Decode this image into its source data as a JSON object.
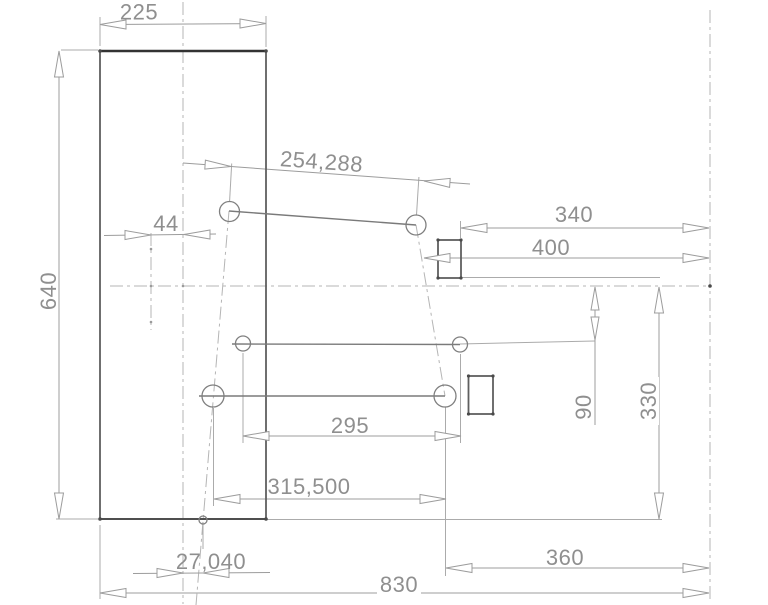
{
  "drawing": {
    "kind": "technical-dimension-drawing",
    "colors": {
      "background": "#ffffff",
      "part_edge": "#4f4f4f",
      "geometry_line": "#7a7a7a",
      "dimension_line": "#9c9c9c",
      "centerline": "#b5b5b5",
      "text": "#8f8f8f"
    },
    "dims": {
      "width_top": {
        "label": "225",
        "value": 225
      },
      "height_left": {
        "label": "640",
        "value": 640
      },
      "hole_distance": {
        "label": "254,288",
        "value": 254.288
      },
      "offset_center": {
        "label": "44",
        "value": 44
      },
      "right_340": {
        "label": "340",
        "value": 340
      },
      "right_400": {
        "label": "400",
        "value": 400
      },
      "vert_90": {
        "label": "90",
        "value": 90
      },
      "vert_330": {
        "label": "330",
        "value": 330
      },
      "holes_295": {
        "label": "295",
        "value": 295
      },
      "holes_315500": {
        "label": "315,500",
        "value": 315.5
      },
      "bottom_27040": {
        "label": "27,040",
        "value": 27.04
      },
      "bottom_360": {
        "label": "360",
        "value": 360
      },
      "total_830": {
        "label": "830",
        "value": 830
      }
    }
  }
}
